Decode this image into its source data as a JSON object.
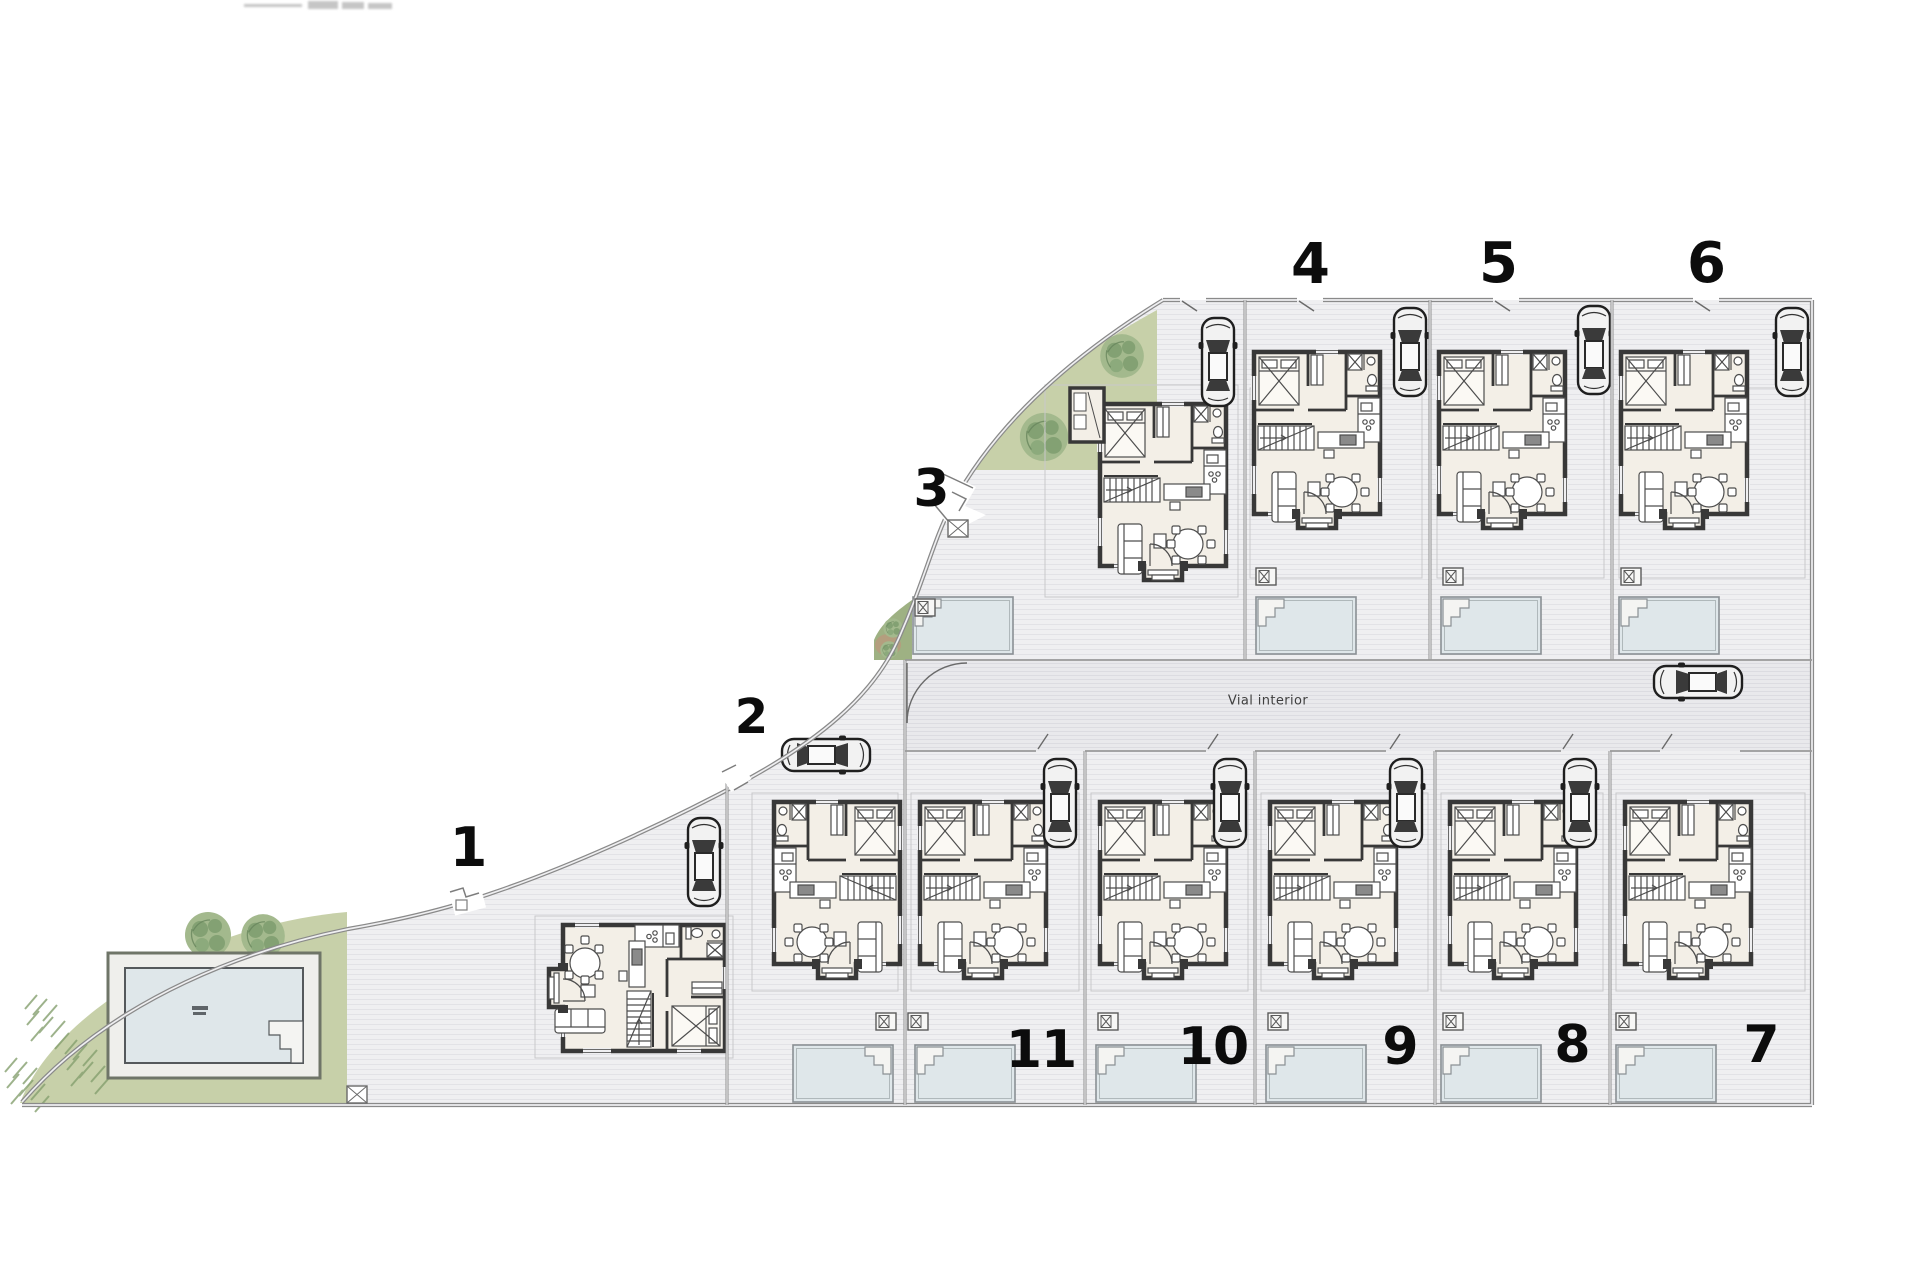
{
  "site_plan": {
    "type": "residential-urbanization-plot-layout",
    "road": {
      "label": "Vial interior"
    },
    "plots": [
      {
        "label": "1"
      },
      {
        "label": "2"
      },
      {
        "label": "3"
      },
      {
        "label": "4"
      },
      {
        "label": "5"
      },
      {
        "label": "6"
      },
      {
        "label": "7"
      },
      {
        "label": "8"
      },
      {
        "label": "9"
      },
      {
        "label": "10"
      },
      {
        "label": "11"
      }
    ],
    "features": [
      "house-floor-plan",
      "swimming-pool",
      "pool-deck",
      "car",
      "tree",
      "garden-green-area",
      "utility-box",
      "entrance-gate",
      "plot-boundary"
    ],
    "colors": {
      "background": "#ffffff",
      "ground": "#efeff1",
      "ground_hatch": "#e2e2e6",
      "road": "#e9e9ec",
      "green": "#c7d0a9",
      "green_dark": "#7e9c6f",
      "earth": "#b99a7d",
      "pool_water": "#dfe7ea",
      "house_floor": "#f3efe7",
      "wall": "#383838",
      "boundary": "#8a8a8a",
      "label": "#0c0c0c"
    }
  }
}
